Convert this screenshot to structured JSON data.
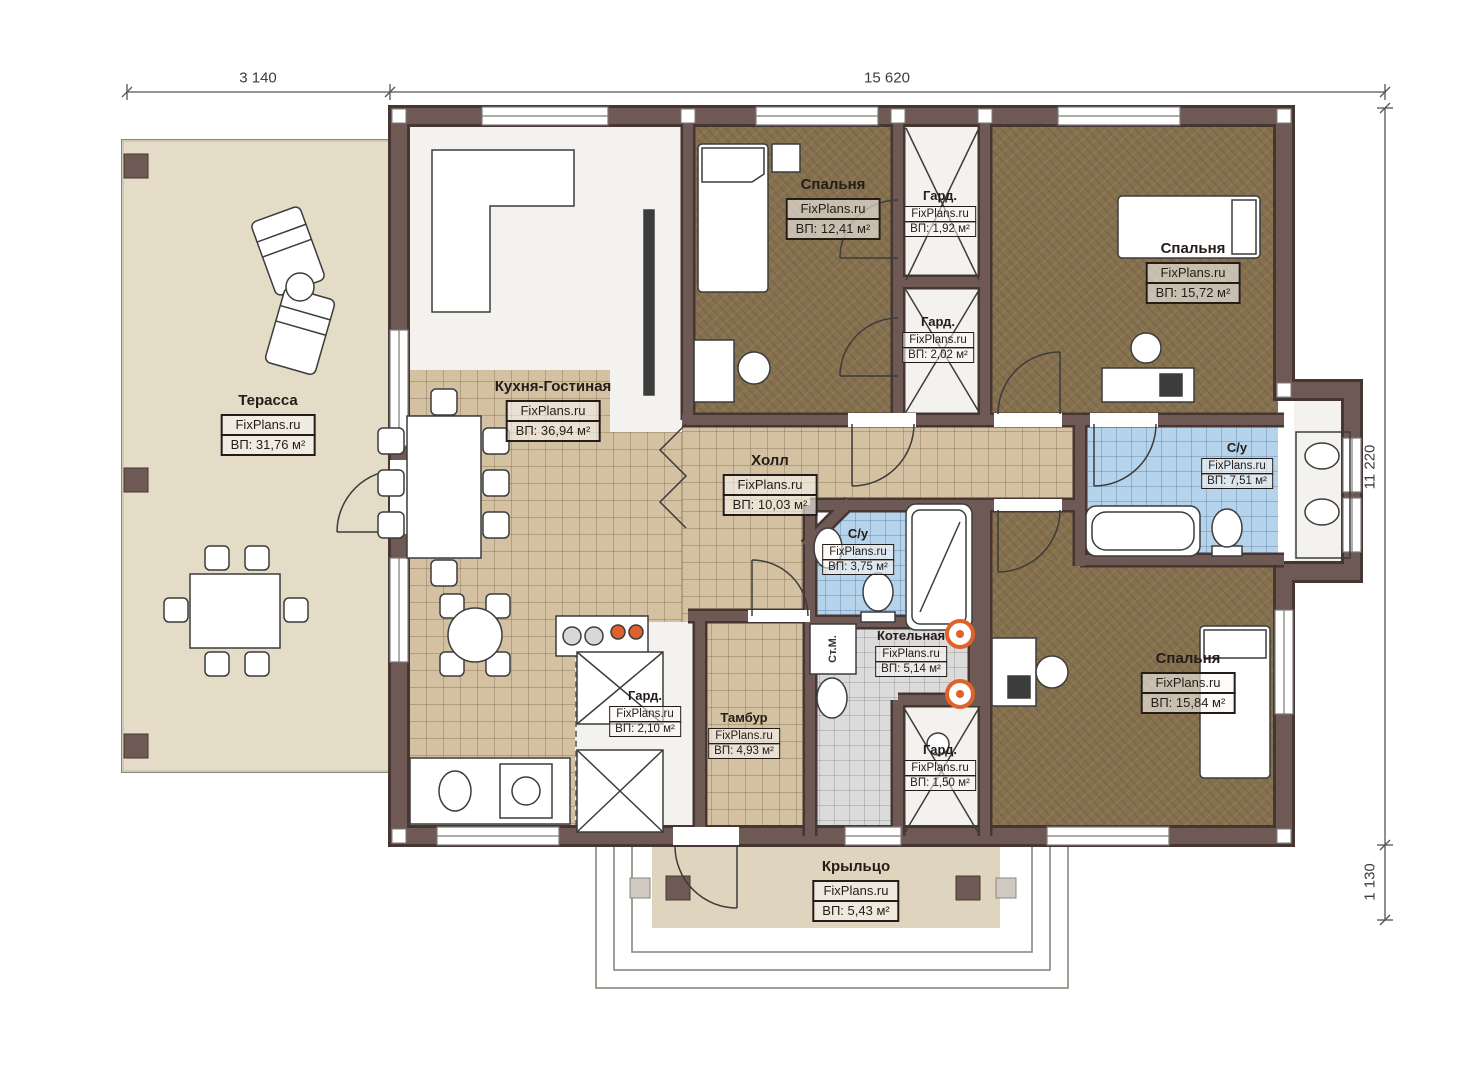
{
  "plan": {
    "watermark": "FixPlans.ru",
    "dimensions": {
      "top_left": "3 140",
      "top_right": "15 620",
      "right_upper": "11 220",
      "right_lower": "1 130"
    },
    "labels": {
      "washing_machine": "Ст.М."
    },
    "rooms": [
      {
        "name": "Терасса",
        "watermark": "FixPlans.ru",
        "area": "ВП: 31,76 м²"
      },
      {
        "name": "Кухня-Гостиная",
        "watermark": "FixPlans.ru",
        "area": "ВП: 36,94 м²"
      },
      {
        "name": "Спальня",
        "watermark": "FixPlans.ru",
        "area": "ВП: 12,41 м²"
      },
      {
        "name": "Гард.",
        "watermark": "FixPlans.ru",
        "area": "ВП: 1,92 м²"
      },
      {
        "name": "Гард.",
        "watermark": "FixPlans.ru",
        "area": "ВП: 2,02 м²"
      },
      {
        "name": "Спальня",
        "watermark": "FixPlans.ru",
        "area": "ВП: 15,72 м²"
      },
      {
        "name": "Холл",
        "watermark": "FixPlans.ru",
        "area": "ВП: 10,03 м²"
      },
      {
        "name": "С/у",
        "watermark": "FixPlans.ru",
        "area": "ВП: 7,51 м²"
      },
      {
        "name": "С/у",
        "watermark": "FixPlans.ru",
        "area": "ВП: 3,75 м²"
      },
      {
        "name": "Котельная",
        "watermark": "FixPlans.ru",
        "area": "ВП: 5,14 м²"
      },
      {
        "name": "Гард.",
        "watermark": "FixPlans.ru",
        "area": "ВП: 2,10 м²"
      },
      {
        "name": "Тамбур",
        "watermark": "FixPlans.ru",
        "area": "ВП: 4,93 м²"
      },
      {
        "name": "Гард.",
        "watermark": "FixPlans.ru",
        "area": "ВП: 1,50 м²"
      },
      {
        "name": "Спальня",
        "watermark": "FixPlans.ru",
        "area": "ВП: 15,84 м²"
      },
      {
        "name": "Крыльцо",
        "watermark": "FixPlans.ru",
        "area": "ВП: 5,43 м²"
      }
    ],
    "colors": {
      "wall": "#6f5954",
      "tile_floor": "#d4c1a2",
      "bedroom_floor": "#86714e",
      "bathroom_floor": "#b5d3ea",
      "boiler_floor": "#dbdbdb",
      "terrace_floor": "#e5dcc7",
      "porch_floor": "#dfd5bf",
      "boiler_accent": "#e0622a"
    }
  }
}
